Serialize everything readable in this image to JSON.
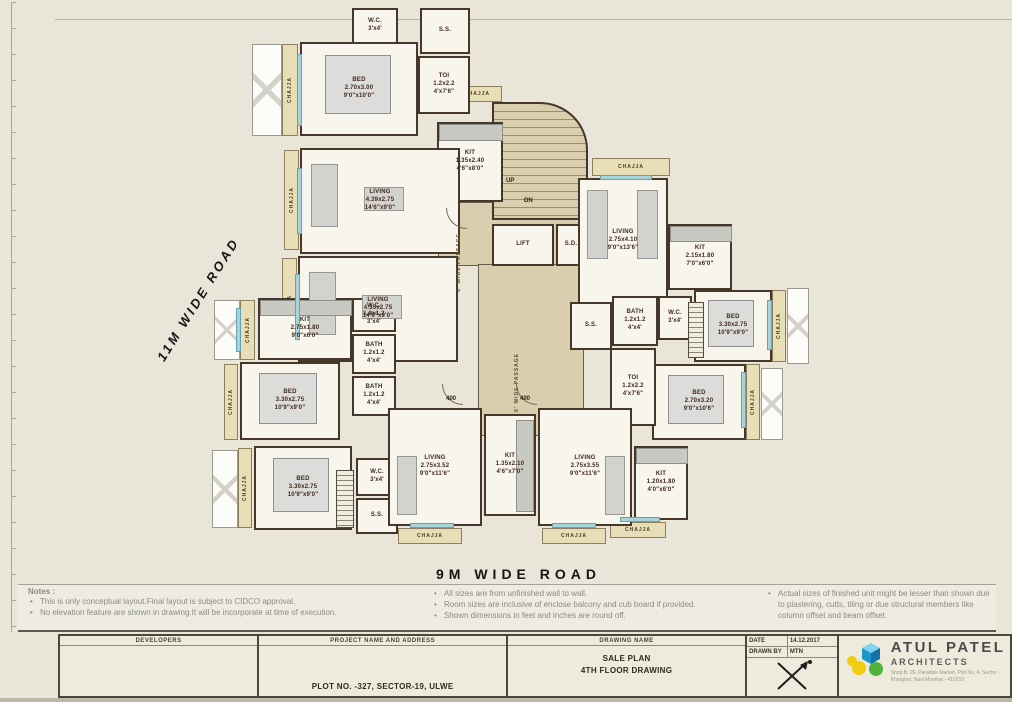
{
  "roads": {
    "left_road": "11M WIDE ROAD",
    "bottom_road": "9M WIDE ROAD"
  },
  "plan": {
    "chajja_label": "CHAJJA",
    "passage_label": "6' WIDE PASSAGE",
    "up_label": "UP",
    "dn_label": "DN",
    "lift_label": "LIFT",
    "sd_label": "S.D.",
    "tags": {
      "a": "400",
      "b": "400"
    },
    "rooms": {
      "bed_tl": "BED\n2.70x3.00\n9'0\"x10'0\"",
      "wc_top": "W.C.\n3'x4'",
      "ss_top": "S.S.",
      "toi_tl": "TOI\n1.2x2.2\n4'x7'6\"",
      "kit_top": "KIT\n1.35x2.40\n4'6\"x8'0\"",
      "living_1": "LIVING\n4.39x2.75\n14'6\"x9'0\"",
      "living_2": "LIVING\n4.35x2.75\n14'6\"x9'0\"",
      "living_r": "LIVING\n2.75x4.10\n9'0\"x13'6\"",
      "kit_r": "KIT\n2.15x1.80\n7'0\"x6'0\"",
      "bed_r1": "BED\n3.30x2.75\n10'9\"x9'0\"",
      "bed_r2": "BED\n2.70x3.20\n9'0\"x10'6\"",
      "ss_mid": "S.S.",
      "bath_m": "BATH\n1.2x1.2\n4'x4'",
      "wc_m": "W.C.\n3'x4'",
      "toi_m": "TOI\n1.2x2.2\n4'x7'6\"",
      "kit_l": "KIT\n2.75x1.80\n9'0\"x6'0\"",
      "wc_l": "W.C.\n1.0x1.2\n3'x4'",
      "bath_l1": "BATH\n1.2x1.2\n4'x4'",
      "bath_l2": "BATH\n1.2x1.2\n4'x4'",
      "bed_bl1": "BED\n3.30x2.75\n10'9\"x9'0\"",
      "bed_bl2": "BED\n3.30x2.75\n10'9\"x9'0\"",
      "wc_c": "W.C.\n3'x4'",
      "ss_b": "S.S.",
      "living_b1": "LIVING\n2.75x3.52\n9'0\"x11'6\"",
      "kit_b": "KIT\n1.35x2.10\n4'6\"x7'0\"",
      "living_b2": "LIVING\n2.75x3.55\n9'0\"x11'6\"",
      "kit_br": "KIT\n1.20x1.80\n4'0\"x6'0\""
    }
  },
  "notes": {
    "heading": "Notes :",
    "col1": [
      "This is only conceptual layout.Final layout is subject to CIDCO approval.",
      "No elevation feature are shown in drawing.It will be incorporate at time of execution."
    ],
    "col2": [
      "All sizes are from unfinished wall to wall.",
      "Room sizes are inclusive of enclose balcony and cub board if provided.",
      "Shown dimensions in feet and inches are round off."
    ],
    "col3": [
      "Actual sizes of finished unit might be lesser than shown due to plastering, cutts, tiling or due structural members like column offset and beam offset."
    ]
  },
  "titleblock": {
    "developers_label": "DEVELOPERS",
    "project_label": "PROJECT NAME AND ADDRESS",
    "project_value": "PLOT NO. -327, SECTOR-19, ULWE",
    "drawing_label": "DRAWING NAME",
    "drawing_value_line1": "SALE PLAN",
    "drawing_value_line2": "4TH FLOOR DRAWING",
    "date_label": "DATE",
    "date_value": "14.12.2017",
    "drawnby_label": "DRAWN BY",
    "drawnby_value": "MTN",
    "firm_name": "ATUL PATEL",
    "firm_subtitle": "ARCHITECTS",
    "firm_address1": "Shop B. 26, Paradise Market, Plot No. 4, Sector -",
    "firm_address2": "Kharghar, Navi Mumbai - 410210"
  },
  "colors": {
    "paper": "#e9e6d9",
    "wall": "#453729",
    "core_tan": "#d9cfae",
    "chajja_tan": "#e7ddb6",
    "window_blue": "#a7d3da",
    "logo_blue": "#2ba7df",
    "logo_yellow": "#f0cd0f",
    "logo_green": "#4fb23c"
  }
}
